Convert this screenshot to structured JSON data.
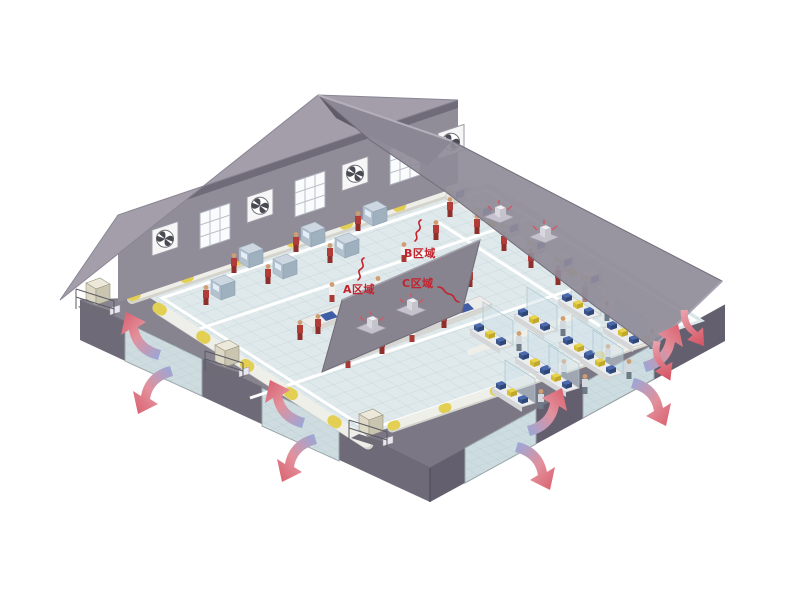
{
  "illustration": {
    "type": "isometric factory ventilation cutaway",
    "labels": {
      "area_a": "A区域",
      "area_b": "B区域",
      "area_c": "C区域"
    },
    "colors": {
      "background": "#ffffff",
      "label_red": "#c4222c",
      "intake_blue": "#93a9dc",
      "exhaust_red": "#da5d6c",
      "roof_gray": "#8f8b98",
      "wall_gray": "#6e6a78",
      "floor_tile": "#dfe9eb",
      "machine_blue": "#4a68ae",
      "machine_yellow": "#e8d34a",
      "duct_white": "#efefe9",
      "vent_unit_beige": "#ece9da",
      "worker_red": "#b23c38"
    }
  }
}
